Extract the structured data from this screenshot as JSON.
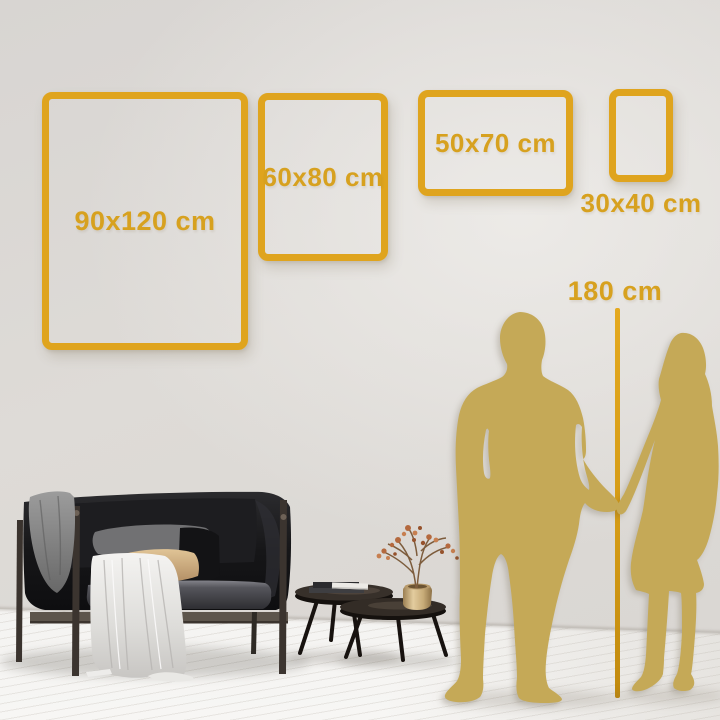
{
  "size_guide": {
    "frames": [
      {
        "id": "frame-90x120",
        "label": "90x120 cm",
        "orientation": "portrait",
        "label_position": "inside"
      },
      {
        "id": "frame-60x80",
        "label": "60x80 cm",
        "orientation": "portrait",
        "label_position": "inside"
      },
      {
        "id": "frame-50x70",
        "label": "50x70 cm",
        "orientation": "landscape",
        "label_position": "inside"
      },
      {
        "id": "frame-30x40",
        "label": "30x40 cm",
        "orientation": "portrait",
        "label_position": "below"
      }
    ],
    "height_reference": {
      "label": "180 cm"
    }
  },
  "colors": {
    "frame_gold": "#dfa41e",
    "text_gold": "#d7a11f",
    "silhouette_gold": "#c5a957",
    "wall_gray": "#dcd9d5",
    "floor_white": "#f6f5f3"
  },
  "scene_elements": [
    "man-silhouette",
    "woman-silhouette",
    "height-measure-line",
    "sofa",
    "gray-throw-blanket",
    "white-draped-cloth",
    "gray-pillow",
    "tan-pillow",
    "black-pillow",
    "nesting-coffee-tables",
    "book-stack",
    "brass-vase",
    "dried-flower-branch"
  ]
}
